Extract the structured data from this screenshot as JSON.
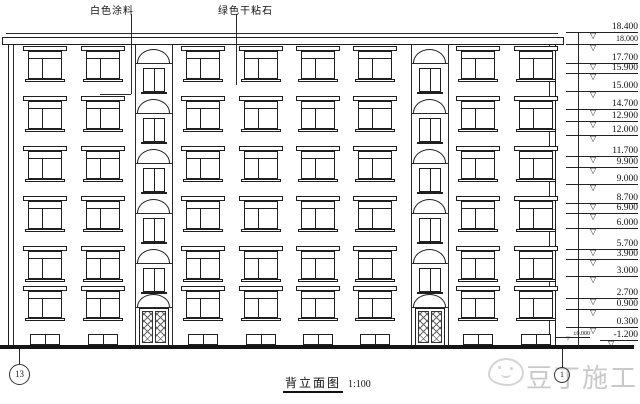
{
  "drawing": {
    "material_labels": [
      "白色涂料",
      "绿色干粘石"
    ],
    "title": "背立面图",
    "scale": "1:100",
    "elevations": [
      "18.400",
      "18.000",
      "17.700",
      "15.900",
      "15.000",
      "14.700",
      "12.900",
      "12.000",
      "11.700",
      "9.900",
      "9.000",
      "8.700",
      "6.900",
      "6.000",
      "5.700",
      "3.900",
      "3.000",
      "2.700",
      "0.900",
      "0.300",
      "±0.000",
      "-1.200"
    ],
    "axis_labels": {
      "left": "13",
      "right": "1"
    },
    "floors": 6,
    "watermark": "豆丁施工",
    "colors": {
      "line": "#1f1f1f",
      "watermark": "#c9c9c9",
      "background": "#ffffff"
    }
  }
}
